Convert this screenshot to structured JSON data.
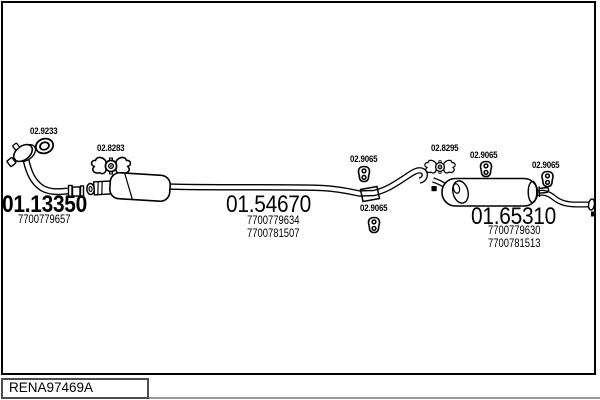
{
  "plate": {
    "code": "RENA97469A",
    "background": "#ffffff",
    "line_color": "#000000"
  },
  "parts": [
    {
      "id": "01.13350",
      "oe": [
        "7700779657"
      ],
      "style": "bold"
    },
    {
      "id": "01.54670",
      "oe": [
        "7700779634",
        "7700781507"
      ],
      "style": "regular"
    },
    {
      "id": "01.65310",
      "oe": [
        "7700779630",
        "7700781513"
      ],
      "style": "regular"
    }
  ],
  "fittings": [
    {
      "id": "02.9233",
      "icon": "gasket-ring-icon"
    },
    {
      "id": "02.8283",
      "icon": "clamp-icon"
    },
    {
      "id": "02.9065",
      "icon": "hanger-icon"
    },
    {
      "id": "02.9065",
      "icon": "hanger-icon"
    },
    {
      "id": "02.8295",
      "icon": "clamp-icon"
    },
    {
      "id": "02.9065",
      "icon": "hanger-icon"
    },
    {
      "id": "02.9065",
      "icon": "hanger-icon"
    }
  ]
}
